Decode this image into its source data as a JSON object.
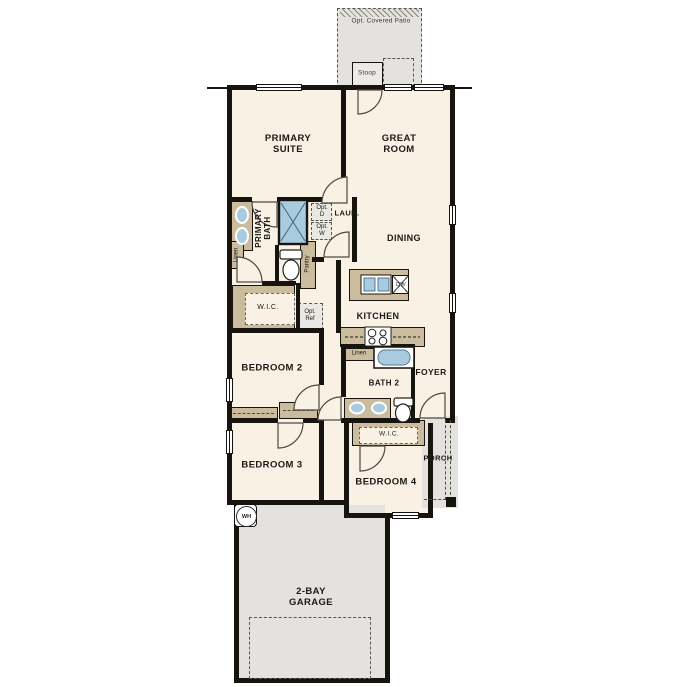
{
  "plan_title": "single-story floor plan",
  "palette": {
    "wall": "#17140f",
    "interior": "#f8f1e4",
    "exterior_concrete": "#e3e2df",
    "casework_tan": "#cbbc9e",
    "fixture_blue": "#a9cbe0"
  },
  "labels": {
    "patio": "Opt. Covered Patio",
    "stoop": "Stoop",
    "primary_suite": "PRIMARY\nSUITE",
    "great_room": "GREAT\nROOM",
    "primary_bath": "PRIMARY\nBATH",
    "linen_primary": "Linen",
    "laundry": "LAUN.",
    "opt_dryer": "Opt.\nD",
    "opt_washer": "Opt.\nW",
    "pantry": "Pantry",
    "wic_primary": "W.I.C.",
    "opt_ref": "Opt.\nRef",
    "dining": "DINING",
    "kitchen": "KITCHEN",
    "dishwasher": "DW",
    "linen_hall": "Linen",
    "bath2": "BATH 2",
    "foyer": "FOYER",
    "wic_bed4": "W.I.C.",
    "bedroom2": "BEDROOM 2",
    "bedroom3": "BEDROOM 3",
    "bedroom4": "BEDROOM 4",
    "porch": "PORCH",
    "water_heater": "WH",
    "garage": "2-BAY\nGARAGE"
  }
}
